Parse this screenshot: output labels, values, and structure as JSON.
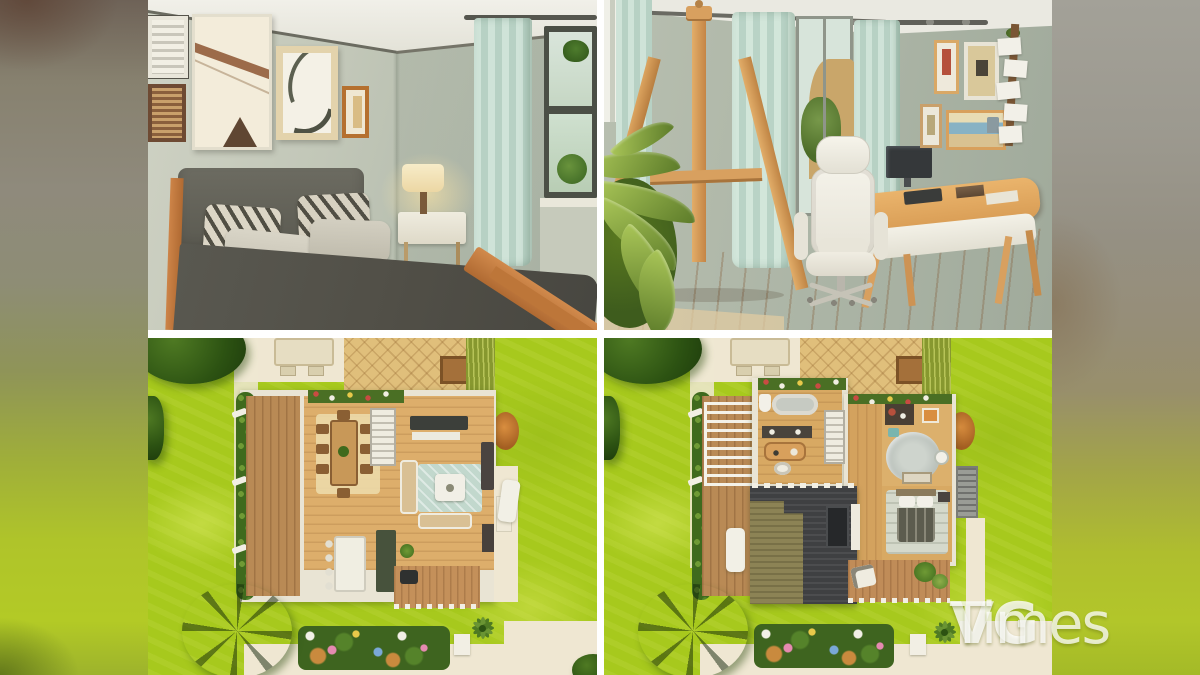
{
  "watermark": {
    "vg": "VG",
    "times": "Times",
    "color": "#ffffff"
  },
  "panels": [
    {
      "name": "bedroom-screenshot"
    },
    {
      "name": "home-office-screenshot"
    },
    {
      "name": "ground-floor-plan-screenshot"
    },
    {
      "name": "upper-floor-plan-screenshot"
    }
  ],
  "palette": {
    "lawn_green": "#a7c91d",
    "lawn_light": "#c3da45",
    "path_cream": "#efe7d2",
    "tree_dark": "#2c5212",
    "wall_sage": "#b4bcad",
    "ceiling_white": "#edece3",
    "curtain_mint": "#c5ddd2",
    "wood_floor": "#ddae6b",
    "wood_accent": "#c1773c",
    "bed_charcoal": "#55544a",
    "roof_charcoal": "#3f4042",
    "roof_khaki": "#8c8355",
    "rug_teal": "#c2d8cd",
    "patio_tan": "#e0bf7b",
    "grid_gap": "#ffffff"
  }
}
